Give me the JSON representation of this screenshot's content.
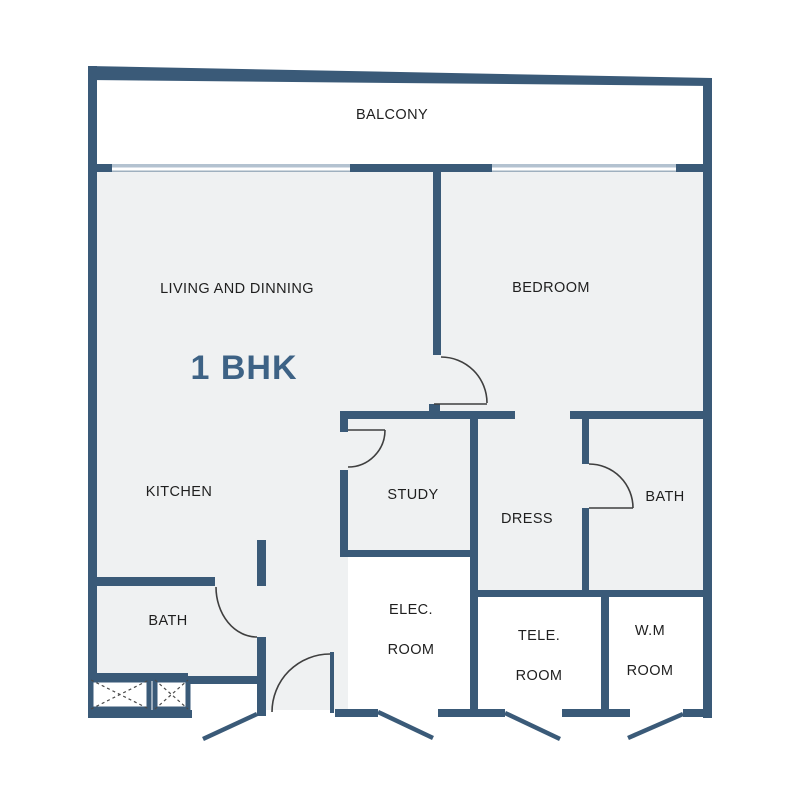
{
  "plan": {
    "title": "1 BHK",
    "rooms": [
      {
        "id": "balcony",
        "label": "BALCONY"
      },
      {
        "id": "living",
        "label": "LIVING AND DINNING"
      },
      {
        "id": "bedroom",
        "label": "BEDROOM"
      },
      {
        "id": "kitchen",
        "label": "KITCHEN"
      },
      {
        "id": "study",
        "label": "STUDY"
      },
      {
        "id": "dress",
        "label": "DRESS"
      },
      {
        "id": "bath_right",
        "label": "BATH"
      },
      {
        "id": "bath_left",
        "label": "BATH"
      },
      {
        "id": "elec_room",
        "label": "ELEC.",
        "label2": "ROOM"
      },
      {
        "id": "tele_room",
        "label": "TELE.",
        "label2": "ROOM"
      },
      {
        "id": "wm_room",
        "label": "W.M",
        "label2": "ROOM"
      }
    ],
    "colors": {
      "wall": "#3a5a78",
      "room_fill": "#eff1f2",
      "accent_title": "#3d6285",
      "window": "#b3c2d0",
      "door_line": "#3f3f3f",
      "text": "#1f1f1f",
      "background": "#ffffff"
    }
  }
}
